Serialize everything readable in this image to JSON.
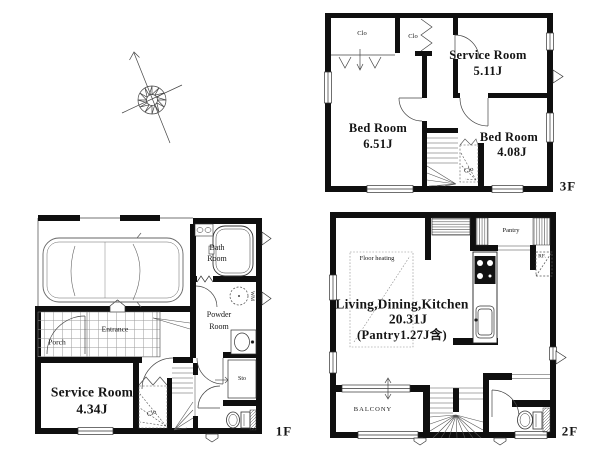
{
  "page": {
    "background": "#ffffff",
    "ink": "#111111"
  },
  "compass": {
    "icon": "north-arrow-compass"
  },
  "floor3": {
    "label": "3F",
    "service_room": {
      "name": "Service Room",
      "area": "5.11J"
    },
    "bedroom_left": {
      "name": "Bed Room",
      "area": "6.51J"
    },
    "bedroom_right": {
      "name": "Bed Room",
      "area": "4.08J"
    },
    "closet_left": "Clo",
    "closet_mid": "Clo",
    "closet_stair": "Clo"
  },
  "floor2": {
    "label": "2F",
    "ldk": {
      "name": "Living,Dining,Kitchen",
      "area": "20.31J",
      "note": "(Pantry1.27J含)"
    },
    "pantry": "Pantry",
    "refrigerator": "RF.",
    "floor_heating": "Floor heating",
    "balcony": "BALCONY"
  },
  "floor1": {
    "label": "1F",
    "service_room": {
      "name": "Service Room",
      "area": "4.34J"
    },
    "bath_room": {
      "line1": "Bath",
      "line2": "Room"
    },
    "powder_room": {
      "line1": "Powder",
      "line2": "Room"
    },
    "entrance": "Entrance",
    "porch": "Porch",
    "closet": "Clo",
    "storage": "Sto",
    "washing_machine": "WM"
  }
}
